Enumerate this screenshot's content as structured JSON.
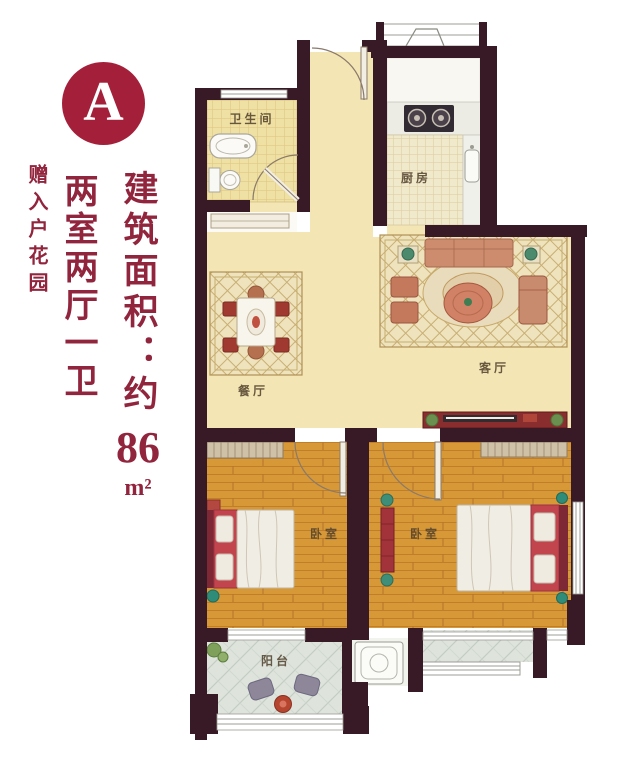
{
  "badge": {
    "letter": "A"
  },
  "panel": {
    "area_label": "建筑面积：约",
    "area_value": "86",
    "area_unit": "m²",
    "layout": "两室两厅一卫",
    "bonus": "赠入户花园"
  },
  "floorplan": {
    "rooms": [
      {
        "id": "bathroom",
        "label": "卫生间"
      },
      {
        "id": "kitchen",
        "label": "厨房"
      },
      {
        "id": "dining",
        "label": "餐厅"
      },
      {
        "id": "living",
        "label": "客厅"
      },
      {
        "id": "bedroom_left",
        "label": "卧室"
      },
      {
        "id": "bedroom_right",
        "label": "卧室"
      },
      {
        "id": "balcony",
        "label": "阳台"
      }
    ]
  },
  "colors": {
    "accent_text": "#92253E",
    "badge_bg": "#A4203A",
    "wall": "#381A27",
    "floor_cream": "#F4E5B4",
    "wood_floor": "#D79838",
    "bath_tile": "#EFE0A4",
    "balcony_tile": "#DEE4DC",
    "rug_base": "#EEE3BC",
    "sofa": "#CE8C6F",
    "bed_red": "#C2454E",
    "tv_stand": "#8A2D2E"
  }
}
